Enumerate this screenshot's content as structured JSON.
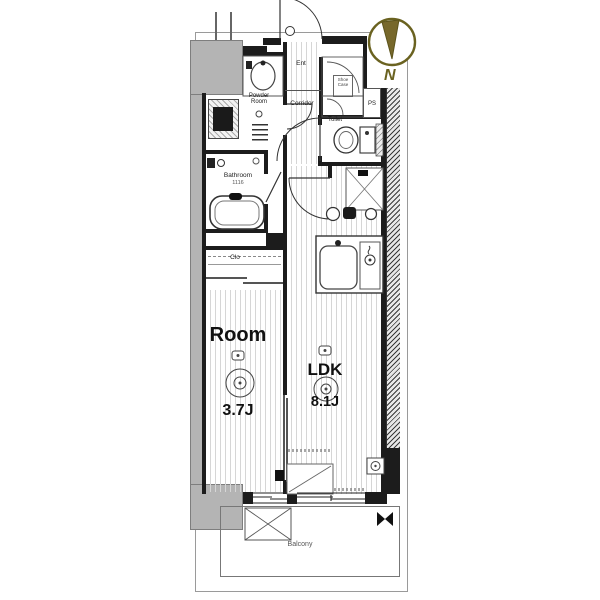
{
  "plan": {
    "labels": {
      "ent": "Ent",
      "corridor": "Corridor",
      "powder_room": "Powder\nRoom",
      "toilet": "Toilet",
      "ps": "PS",
      "bathroom": "Bathroom",
      "bathroom_size": "1116",
      "closet": "Clo",
      "shoe_case": "Shoe\nCase",
      "room": "Room",
      "room_size": "3.7J",
      "ldk": "LDK",
      "ldk_size": "8.1J",
      "balcony": "Balcony",
      "north": "N"
    },
    "colors": {
      "wall": "#1c1c1c",
      "gray_mass": "#b4b4b4",
      "floor_stripe": "#d6d6d6",
      "compass": "#6a6220",
      "compass_wedge": "#77682b"
    }
  }
}
